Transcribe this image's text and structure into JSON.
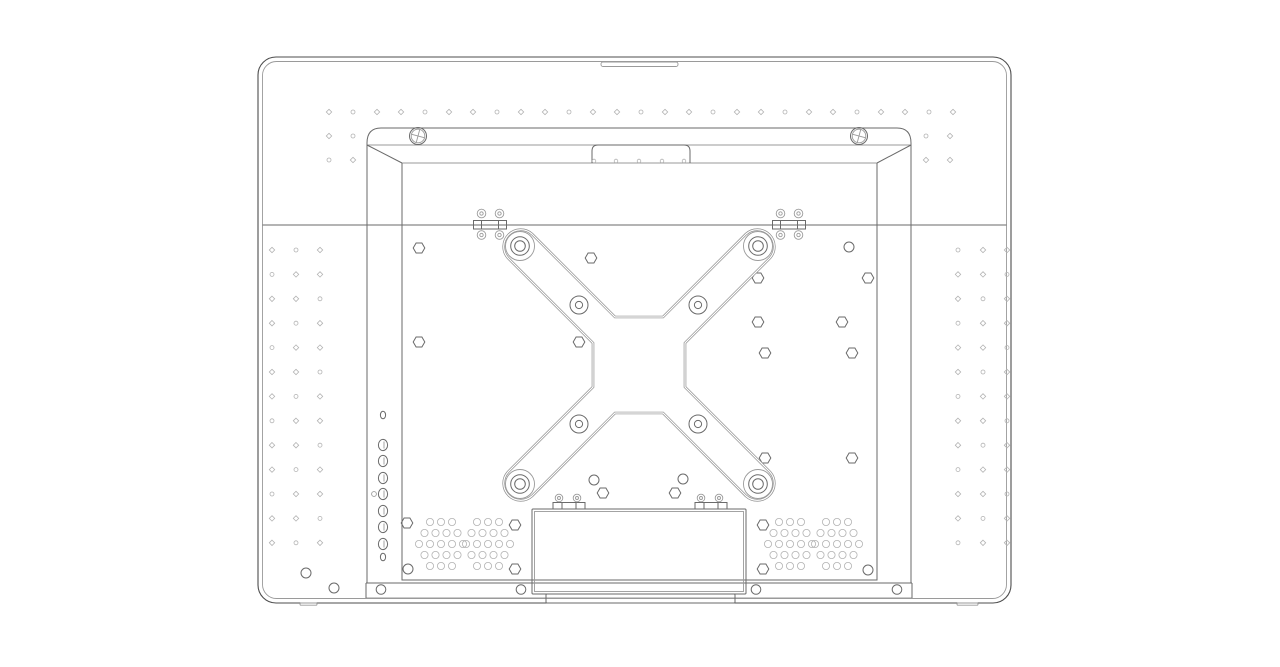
{
  "canvas": {
    "w": 1280,
    "h": 667
  },
  "colors": {
    "background": "#ffffff",
    "line": "#6a6a6a",
    "line_dark": "#4d4d4d",
    "line_light": "#9a9a9a",
    "line_faint": "#b3b3b3",
    "double_line": "#8f8f8f"
  },
  "outer_case": {
    "x": 258,
    "y": 57,
    "w": 753,
    "h": 546,
    "radius": 18,
    "inner_inset": 4.5,
    "handle_notch": {
      "x": 601,
      "y": 62,
      "w": 77,
      "h": 4.5,
      "r": 2
    },
    "feet": [
      {
        "x": 300,
        "w": 17
      },
      {
        "x": 957,
        "w": 21
      }
    ],
    "foot_y": 603,
    "foot_h": 2.2
  },
  "seam": {
    "y": 225,
    "x1": 262.5,
    "x2": 1006.5
  },
  "frame": {
    "top_y": 128,
    "top_x1": 381,
    "top_x2": 897,
    "corner_r": 14,
    "outer_x1": 367,
    "outer_x2": 911,
    "corner_drop_y": 143,
    "mid_y": 145,
    "inner_y": 163,
    "inner_x1": 402,
    "inner_x2": 877,
    "wall_y2": 583,
    "panel_x1": 402,
    "panel_x2": 877,
    "panel_y1": 163,
    "panel_y2": 580,
    "chamfers": [
      [
        367,
        145,
        402,
        163
      ],
      [
        911,
        145,
        877,
        163
      ]
    ],
    "tab": {
      "x1": 592,
      "x2": 690,
      "y1": 145,
      "y2": 163,
      "r": 6,
      "hole_y": 161,
      "holes_x": [
        594,
        616,
        639,
        662,
        684
      ],
      "hole_r": 1.8
    },
    "screws": [
      {
        "cx": 418,
        "cy": 136
      },
      {
        "cx": 859,
        "cy": 136
      }
    ],
    "screw_r": [
      8.5,
      6.8
    ],
    "screw_cross_len": 13,
    "screw_cross_angle": 15
  },
  "top_hinges": {
    "xs": [
      473.5,
      772.5
    ],
    "y": 220.5,
    "w": 33,
    "h": 8.5,
    "dividers": [
      8,
      25
    ],
    "circle_dx": [
      8,
      26
    ],
    "circle_dy_above": -7,
    "circle_dy_below": 14.5,
    "r_outer": 4.3,
    "r_inner": 1.7
  },
  "bracket": {
    "outline": "M 508,258 A 17 17 0 0 1 532,234 L 615,317 L 663,317 L 746,234 A 17 17 0 0 1 770,258 L 685,343 L 685,387 L 770,472 A 17 17 0 0 1 746,496 L 663,413 L 615,413 L 532,496 A 17 17 0 0 1 508,472 L 593,387 L 593,343 Z",
    "bosses": [
      [
        520,
        246
      ],
      [
        758,
        246
      ],
      [
        520,
        484
      ],
      [
        758,
        484
      ]
    ],
    "boss_r": [
      14.5,
      9.3,
      5.3
    ],
    "mid_holes": [
      [
        579,
        305
      ],
      [
        698,
        305
      ],
      [
        579,
        424
      ],
      [
        698,
        424
      ]
    ],
    "mid_r": [
      9,
      3.6
    ]
  },
  "buttons": {
    "x": 383,
    "big_ys": [
      445,
      461,
      478,
      494,
      511,
      527,
      544
    ],
    "rx": 4.6,
    "ry": 5.6,
    "small": [
      [
        383,
        415
      ],
      [
        383,
        557
      ]
    ],
    "small_r": 3.2,
    "side": [
      374,
      494
    ],
    "side_r": 2.4
  },
  "stand_box": {
    "x": 532,
    "y": 509,
    "w": 214,
    "h": 85,
    "inset": 2.5,
    "lip": {
      "x": 546,
      "y": 594,
      "w": 189,
      "h": 9
    },
    "hinges": {
      "xs": [
        553,
        695
      ],
      "y": 502.5,
      "w": 32,
      "h": 6.5,
      "dividers": [
        9,
        23
      ],
      "circle_dx": [
        6,
        24
      ],
      "circle_dy": -4.5,
      "r_outer": 3.8,
      "r_inner": 1.5
    }
  },
  "bottom_strip": {
    "y1": 583,
    "y2": 598,
    "x1": 366,
    "x2": 912,
    "circles_x": [
      381,
      521,
      756,
      897
    ],
    "circles_y": 589.5,
    "r": 4.8
  },
  "panel_holes": {
    "hex_r": 5.8,
    "hex": [
      [
        419,
        248
      ],
      [
        591,
        258
      ],
      [
        758,
        278
      ],
      [
        868,
        278
      ],
      [
        419,
        342
      ],
      [
        579,
        342
      ],
      [
        758,
        322
      ],
      [
        842,
        322
      ],
      [
        765,
        353
      ],
      [
        852,
        353
      ],
      [
        765,
        458
      ],
      [
        852,
        458
      ],
      [
        603,
        493
      ],
      [
        675,
        493
      ],
      [
        407,
        523
      ],
      [
        515,
        525
      ],
      [
        763,
        525
      ],
      [
        515,
        569
      ],
      [
        763,
        569
      ]
    ],
    "circle_r": 5,
    "circles": [
      [
        849,
        247
      ],
      [
        594,
        480
      ],
      [
        683,
        479
      ],
      [
        408,
        569
      ],
      [
        868,
        570
      ],
      [
        306,
        573
      ],
      [
        334,
        588
      ]
    ]
  },
  "vents": {
    "centers": [
      [
        441,
        544
      ],
      [
        488,
        544
      ],
      [
        790,
        544
      ],
      [
        837,
        544
      ]
    ],
    "row_dy": 11,
    "col_dx": 11,
    "counts": [
      3,
      4,
      5,
      4,
      3
    ],
    "r": 3.6
  },
  "dots": {
    "size": 2.7,
    "ring_r": 2,
    "top_row": {
      "y": 112,
      "x0": 329,
      "step": 24,
      "count": 27
    },
    "left_pairs": {
      "xs": [
        329,
        353
      ],
      "ys": [
        136,
        160
      ]
    },
    "right_pairs": {
      "xs": [
        926,
        950
      ],
      "ys": [
        136,
        160
      ]
    },
    "left_grid": {
      "xs": [
        272,
        296,
        320
      ],
      "y0": 250,
      "step": 24.4,
      "count": 13
    },
    "right_grid": {
      "xs": [
        958,
        983,
        1007
      ],
      "y0": 250,
      "step": 24.4,
      "count": 13
    }
  }
}
